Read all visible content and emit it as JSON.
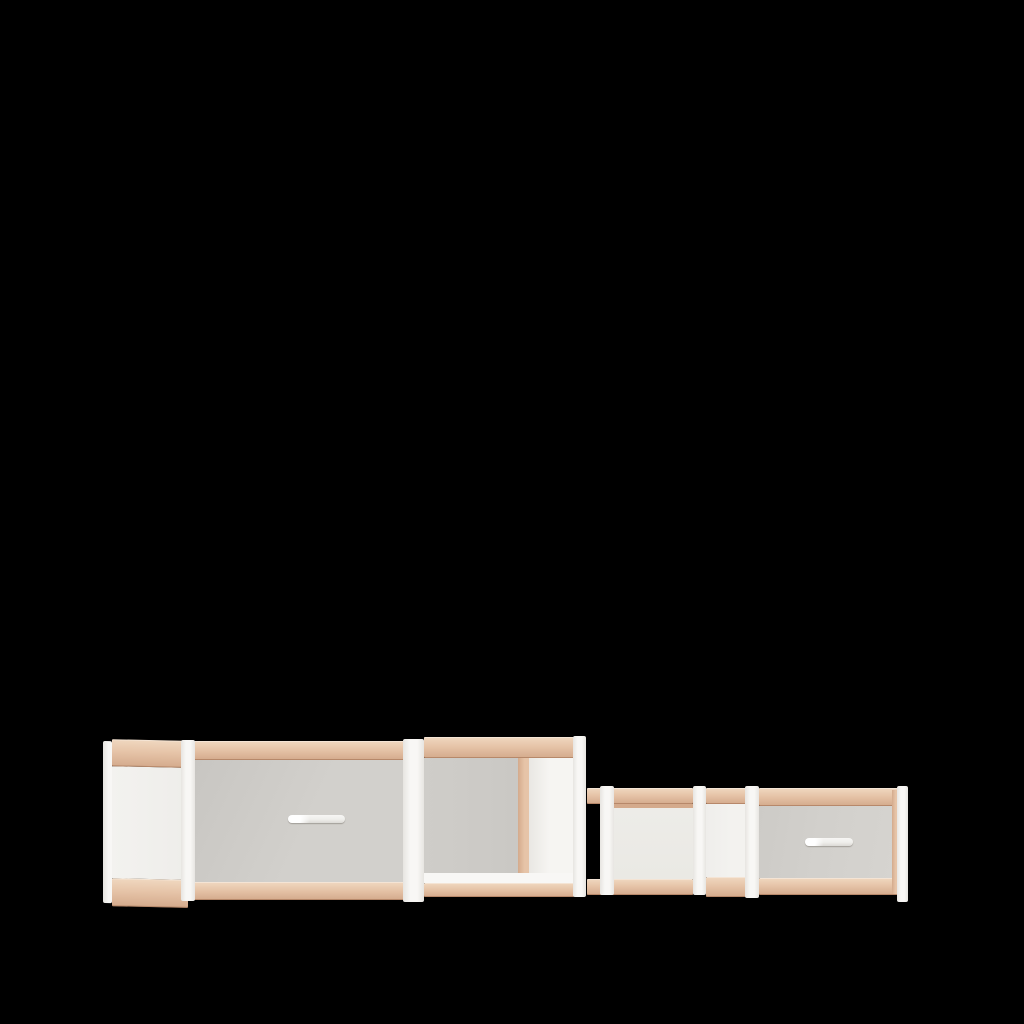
{
  "scene": {
    "type": "3d-product-render",
    "description": "Modular storage sideboard rendered on a plain black background: a tall two-bay section (grey drawer bay plus open compartment) joined to a lower two-bay section (open compartment plus grey drawer bay), built from a white frame with beech wood rails.",
    "background_color": "#000000"
  },
  "colors": {
    "background": "#000000",
    "wood": "#e6c4a8",
    "wood-light": "#f0d8c0",
    "wood-dark": "#d4aa8c",
    "frame-white": "#f8f7f5",
    "frame-shade": "#e7e5e1",
    "panel-white": "#f3f2ef",
    "drawer-grey": "#d2d0cc",
    "drawer-grey-dark": "#c8c6c2",
    "back-grey": "#cfcdc9",
    "back-white": "#edece8",
    "handle": "#efeeeb"
  },
  "furniture": {
    "name": "modular sideboard",
    "handle_count": 2,
    "modules": [
      {
        "id": "left-side-panel",
        "part": "side panel",
        "finish": "white panel with wood top and bottom rails"
      },
      {
        "id": "tall-drawer-bay",
        "part": "drawer bay",
        "front": "grey drawer front with silver bar handle"
      },
      {
        "id": "tall-open-bay",
        "part": "open compartment",
        "interior": "grey back panel, white side wall"
      },
      {
        "id": "low-open-bay",
        "part": "open compartment",
        "interior": "white back panel"
      },
      {
        "id": "low-drawer-bay",
        "part": "drawer bay",
        "front": "grey drawer front with silver bar handle"
      }
    ]
  }
}
